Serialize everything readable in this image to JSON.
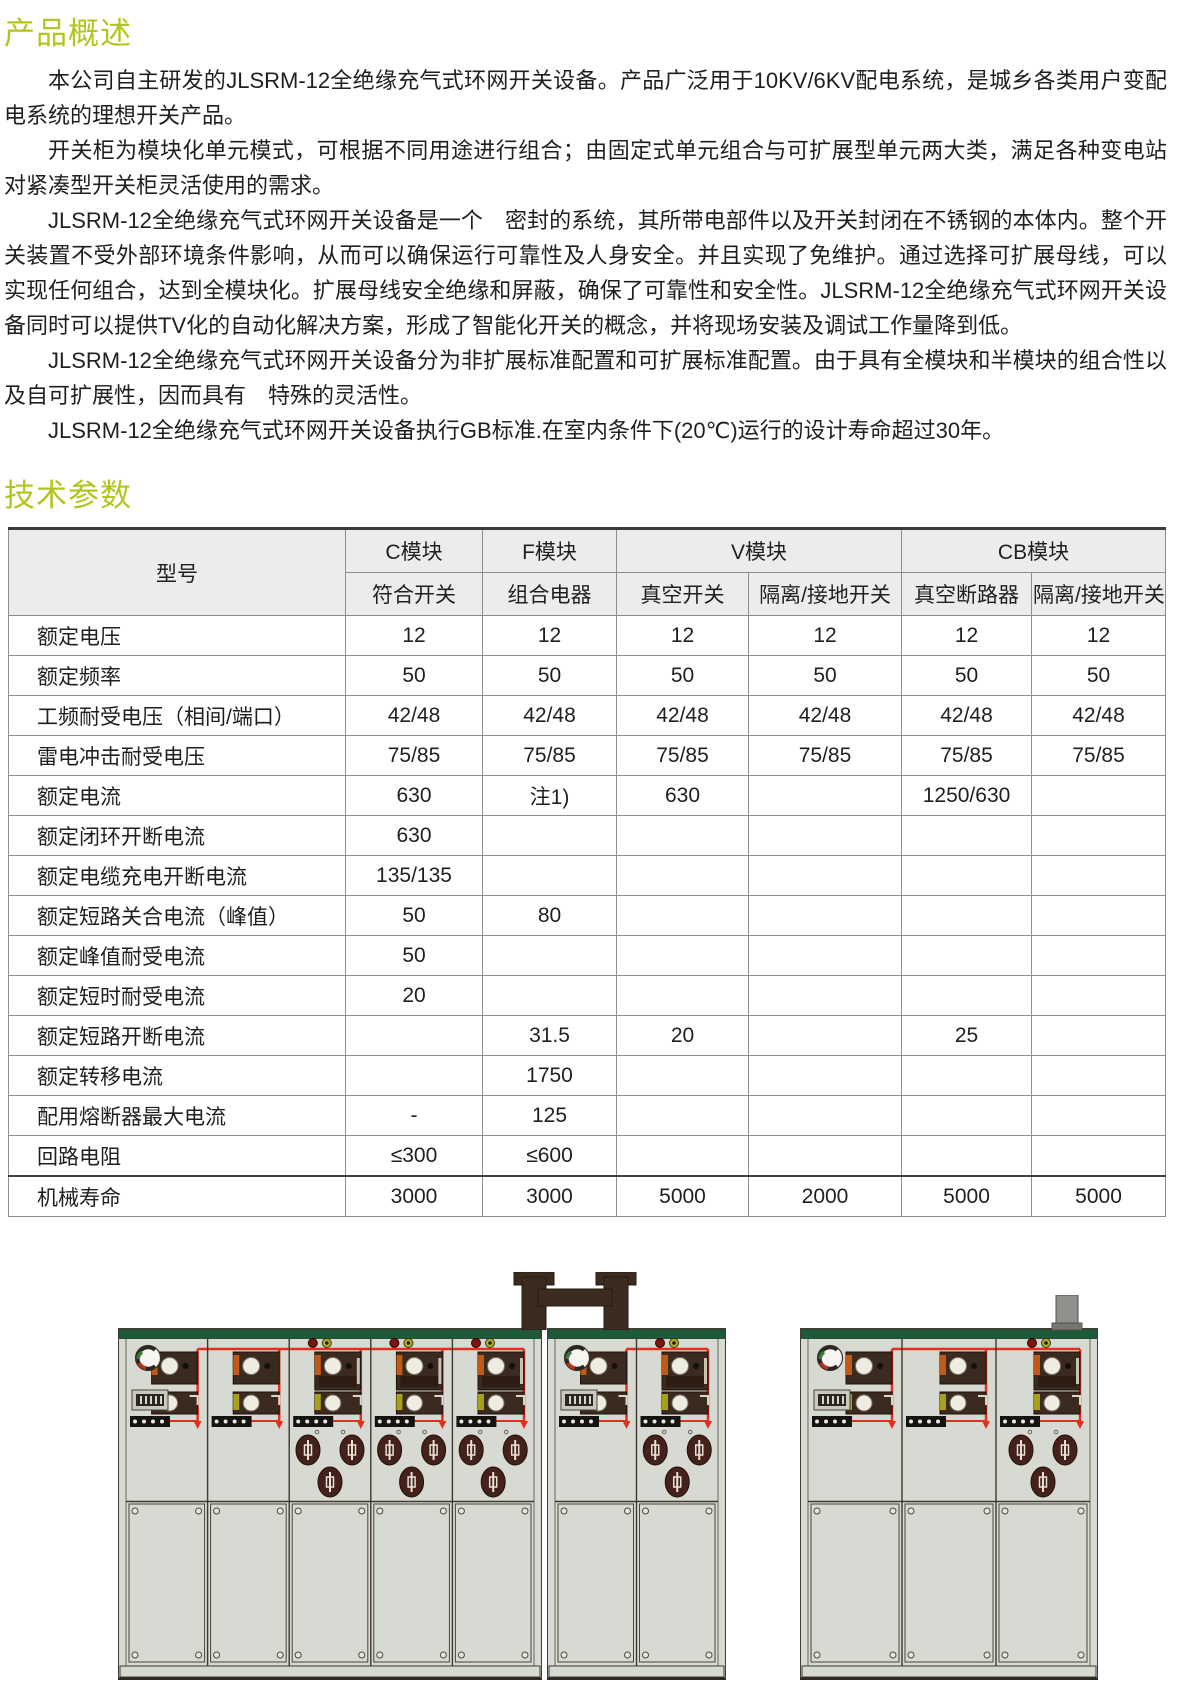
{
  "titles": {
    "overview": "产品概述",
    "params": "技术参数"
  },
  "paragraphs": [
    "本公司自主研发的JLSRM-12全绝缘充气式环网开关设备。产品广泛用于10KV/6KV配电系统，是城乡各类用户变配电系统的理想开关产品。",
    "开关柜为模块化单元模式，可根据不同用途进行组合；由固定式单元组合与可扩展型单元两大类，满足各种变电站对紧凑型开关柜灵活使用的需求。",
    "JLSRM-12全绝缘充气式环网开关设备是一个　密封的系统，其所带电部件以及开关封闭在不锈钢的本体内。整个开关装置不受外部环境条件影响，从而可以确保运行可靠性及人身安全。并且实现了免维护。通过选择可扩展母线，可以实现任何组合，达到全模块化。扩展母线安全绝缘和屏蔽，确保了可靠性和安全性。JLSRM-12全绝缘充气式环网开关设备同时可以提供TV化的自动化解决方案，形成了智能化开关的概念，并将现场安装及调试工作量降到低。",
    "JLSRM-12全绝缘充气式环网开关设备分为非扩展标准配置和可扩展标准配置。由于具有全模块和半模块的组合性以及自可扩展性，因而具有　特殊的灵活性。",
    "JLSRM-12全绝缘充气式环网开关设备执行GB标准.在室内条件下(20℃)运行的设计寿命超过30年。"
  ],
  "table": {
    "model_label": "型号",
    "groups": [
      {
        "label": "C模块",
        "subs": [
          "符合开关"
        ]
      },
      {
        "label": "F模块",
        "subs": [
          "组合电器"
        ]
      },
      {
        "label": "V模块",
        "subs": [
          "真空开关",
          "隔离/接地开关"
        ]
      },
      {
        "label": "CB模块",
        "subs": [
          "真空断路器",
          "隔离/接地开关"
        ]
      }
    ],
    "rows": [
      {
        "label": "额定电压",
        "values": [
          "12",
          "12",
          "12",
          "12",
          "12",
          "12"
        ]
      },
      {
        "label": "额定频率",
        "values": [
          "50",
          "50",
          "50",
          "50",
          "50",
          "50"
        ]
      },
      {
        "label": "工频耐受电压（相间/端口）",
        "values": [
          "42/48",
          "42/48",
          "42/48",
          "42/48",
          "42/48",
          "42/48"
        ]
      },
      {
        "label": "雷电冲击耐受电压",
        "values": [
          "75/85",
          "75/85",
          "75/85",
          "75/85",
          "75/85",
          "75/85"
        ]
      },
      {
        "label": "额定电流",
        "values": [
          "630",
          "注1)",
          "630",
          "",
          "1250/630",
          ""
        ]
      },
      {
        "label": "额定闭环开断电流",
        "values": [
          "630",
          "",
          "",
          "",
          "",
          ""
        ]
      },
      {
        "label": "额定电缆充电开断电流",
        "values": [
          "135/135",
          "",
          "",
          "",
          "",
          ""
        ]
      },
      {
        "label": "额定短路关合电流（峰值）",
        "values": [
          "50",
          "80",
          "",
          "",
          "",
          ""
        ]
      },
      {
        "label": "额定峰值耐受电流",
        "values": [
          "50",
          "",
          "",
          "",
          "",
          ""
        ]
      },
      {
        "label": "额定短时耐受电流",
        "values": [
          "20",
          "",
          "",
          "",
          "",
          ""
        ]
      },
      {
        "label": "额定短路开断电流",
        "values": [
          "",
          "31.5",
          "20",
          "",
          "25",
          ""
        ]
      },
      {
        "label": "额定转移电流",
        "values": [
          "",
          "1750",
          "",
          "",
          "",
          ""
        ]
      },
      {
        "label": "配用熔断器最大电流",
        "values": [
          "-",
          "125",
          "",
          "",
          "",
          ""
        ]
      },
      {
        "label": "回路电阻",
        "values": [
          "≤300",
          "≤600",
          "",
          "",
          "",
          ""
        ]
      },
      {
        "label": "机械寿命",
        "values": [
          "3000",
          "3000",
          "5000",
          "2000",
          "5000",
          "5000"
        ]
      }
    ]
  },
  "colors": {
    "accent": "#b3c41e",
    "cabinet_body": "#d6dad3",
    "cabinet_green": "#1e5a39",
    "mimic_red": "#e2301f",
    "module_dark": "#3a2a20",
    "fuse_dark": "#44211b",
    "bridge_dark": "#3b2c1f"
  },
  "figure": {
    "cabinets": [
      {
        "x": 118,
        "y": 99,
        "w": 424,
        "panels": [
          "switch_logo",
          "switch",
          "breaker",
          "breaker",
          "breaker"
        ]
      },
      {
        "x": 547,
        "y": 99,
        "w": 179,
        "panels": [
          "switch_logo",
          "breaker"
        ]
      },
      {
        "x": 800,
        "y": 99,
        "w": 298,
        "panels": [
          "switch_logo",
          "switch",
          "breaker"
        ]
      }
    ],
    "bridge": {
      "x": 512,
      "y": 43,
      "w": 126,
      "h": 58
    },
    "duct": {
      "x": 1050,
      "y": 66,
      "w": 34,
      "h": 36
    }
  }
}
